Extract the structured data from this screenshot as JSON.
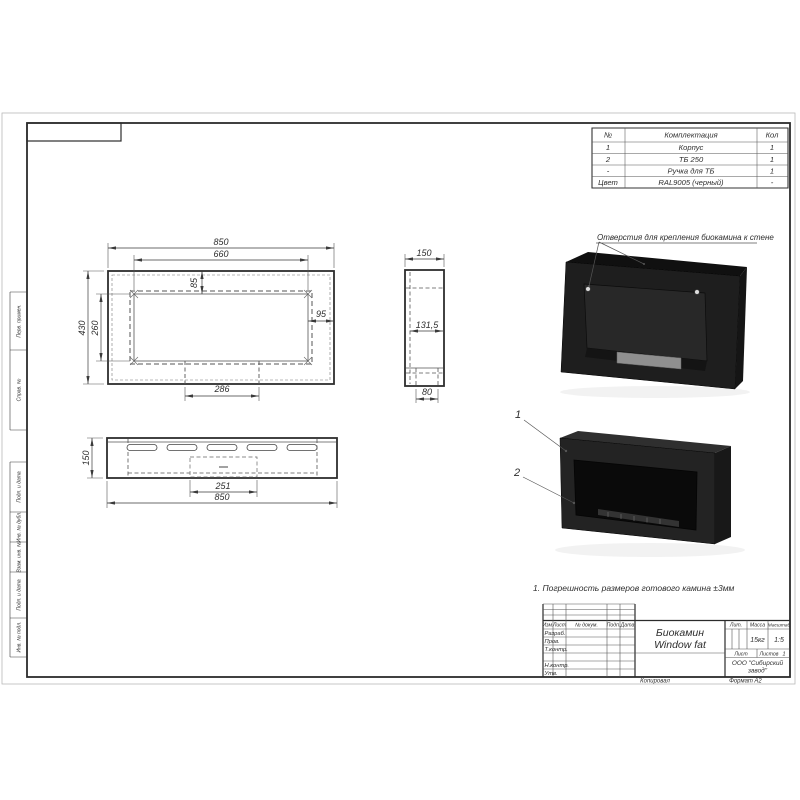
{
  "parts_table": {
    "headers": {
      "num": "№",
      "name": "Комплектация",
      "qty": "Кол"
    },
    "rows": [
      {
        "num": "1",
        "name": "Корпус",
        "qty": "1"
      },
      {
        "num": "2",
        "name": "ТБ 250",
        "qty": "1"
      },
      {
        "num": "-",
        "name": "Ручка для ТБ",
        "qty": "1"
      },
      {
        "num": "Цвет",
        "name": "RAL9005 (черный)",
        "qty": "-"
      }
    ]
  },
  "views": {
    "front": {
      "w": "850",
      "inner_w": "660",
      "h": "430",
      "inner_h": "260",
      "top": "85",
      "side": "95",
      "tab": "286"
    },
    "side": {
      "depth": "150",
      "inner": "131,5",
      "bottom": "80"
    },
    "bottom": {
      "depth": "150",
      "tab": "251",
      "w": "850"
    }
  },
  "annotations": {
    "mount_holes": "Отверстия для крепления биокамина к стене",
    "callout_1": "1",
    "callout_2": "2"
  },
  "notes": {
    "text": "1. Погрешность размеров готового камина ±3мм"
  },
  "title_block": {
    "cols": {
      "izm": "Изм.",
      "list": "Лист",
      "doc": "№ докум.",
      "sign": "Подп.",
      "date": "Дата"
    },
    "roles": [
      "Разраб.",
      "Пров.",
      "Т.контр.",
      "Н.контр.",
      "Утв."
    ],
    "name_line1": "Биокамин",
    "name_line2": "Window fat",
    "lit": "Лит.",
    "mass": "Масса",
    "scale": "Масштаб",
    "mass_value": "15кг",
    "scale_value": "1:5",
    "sheet": "Лист",
    "sheets": "Листов",
    "sheets_value": "1",
    "company_line1": "ООО \"Сибирский",
    "company_line2": "завод\"",
    "copied": "Копировал",
    "format_label": "Формат",
    "format_value": "А2"
  },
  "margin": {
    "labels": [
      "Перв. примен.",
      "Справ. №",
      "Подп. и дата",
      "Инв. № дубл.",
      "Взам. инв. №",
      "Подп. и дата",
      "Инв. № подл."
    ]
  },
  "colors": {
    "body_black": "#1e1e1e",
    "metal_gray": "#8f8f8f",
    "line": "#3a3a3a"
  }
}
